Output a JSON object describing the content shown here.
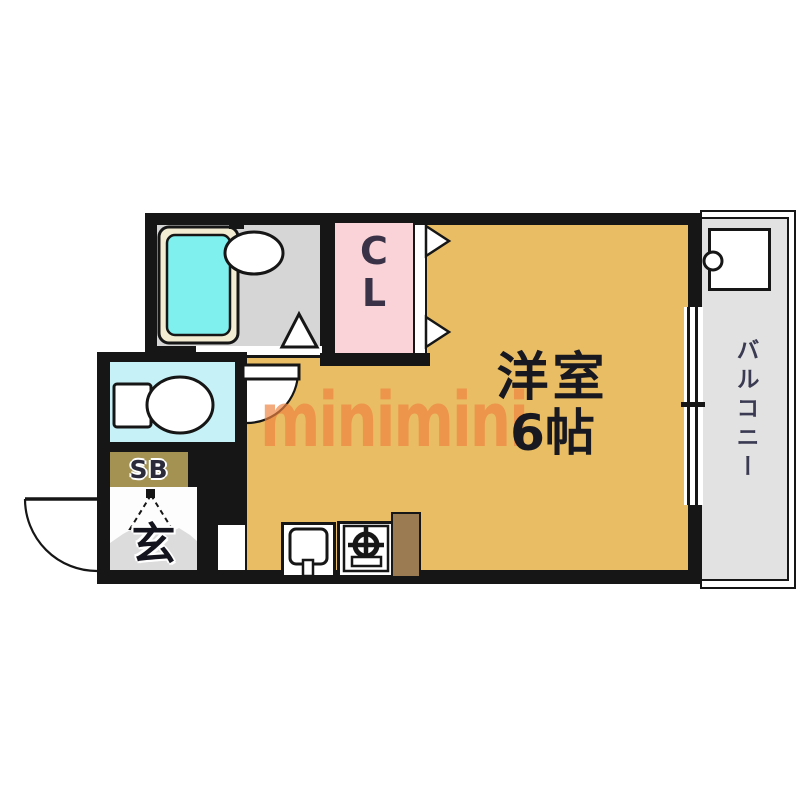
{
  "floor_plan": {
    "watermark": "minimini",
    "labels": {
      "main_room_name": "洋室",
      "main_room_size": "6帖",
      "closet_line1": "C",
      "closet_line2": "L",
      "balcony": "バルコニー",
      "shoe_box": "SB",
      "entrance": "玄"
    },
    "colors": {
      "wall": "#161616",
      "main_room_floor": "#e9bd63",
      "closet_floor": "#f9d3d8",
      "bathroom_floor": "#d6d6d6",
      "bathtub": "#7ff0ee",
      "bathtub_rim": "#f2ecd2",
      "toilet_room_floor": "#c6f2f7",
      "balcony_floor": "#e2e2e2",
      "shoe_box_fill": "#a39252",
      "entrance_step": "#dcdcdc",
      "kitchen_counter_wood": "#9b7b52",
      "watermark_orange": "#ee8340"
    },
    "fixtures": [
      "bathtub",
      "washbasin",
      "toilet",
      "kitchen-sink",
      "gas-stove",
      "washing-machine-pan"
    ]
  }
}
